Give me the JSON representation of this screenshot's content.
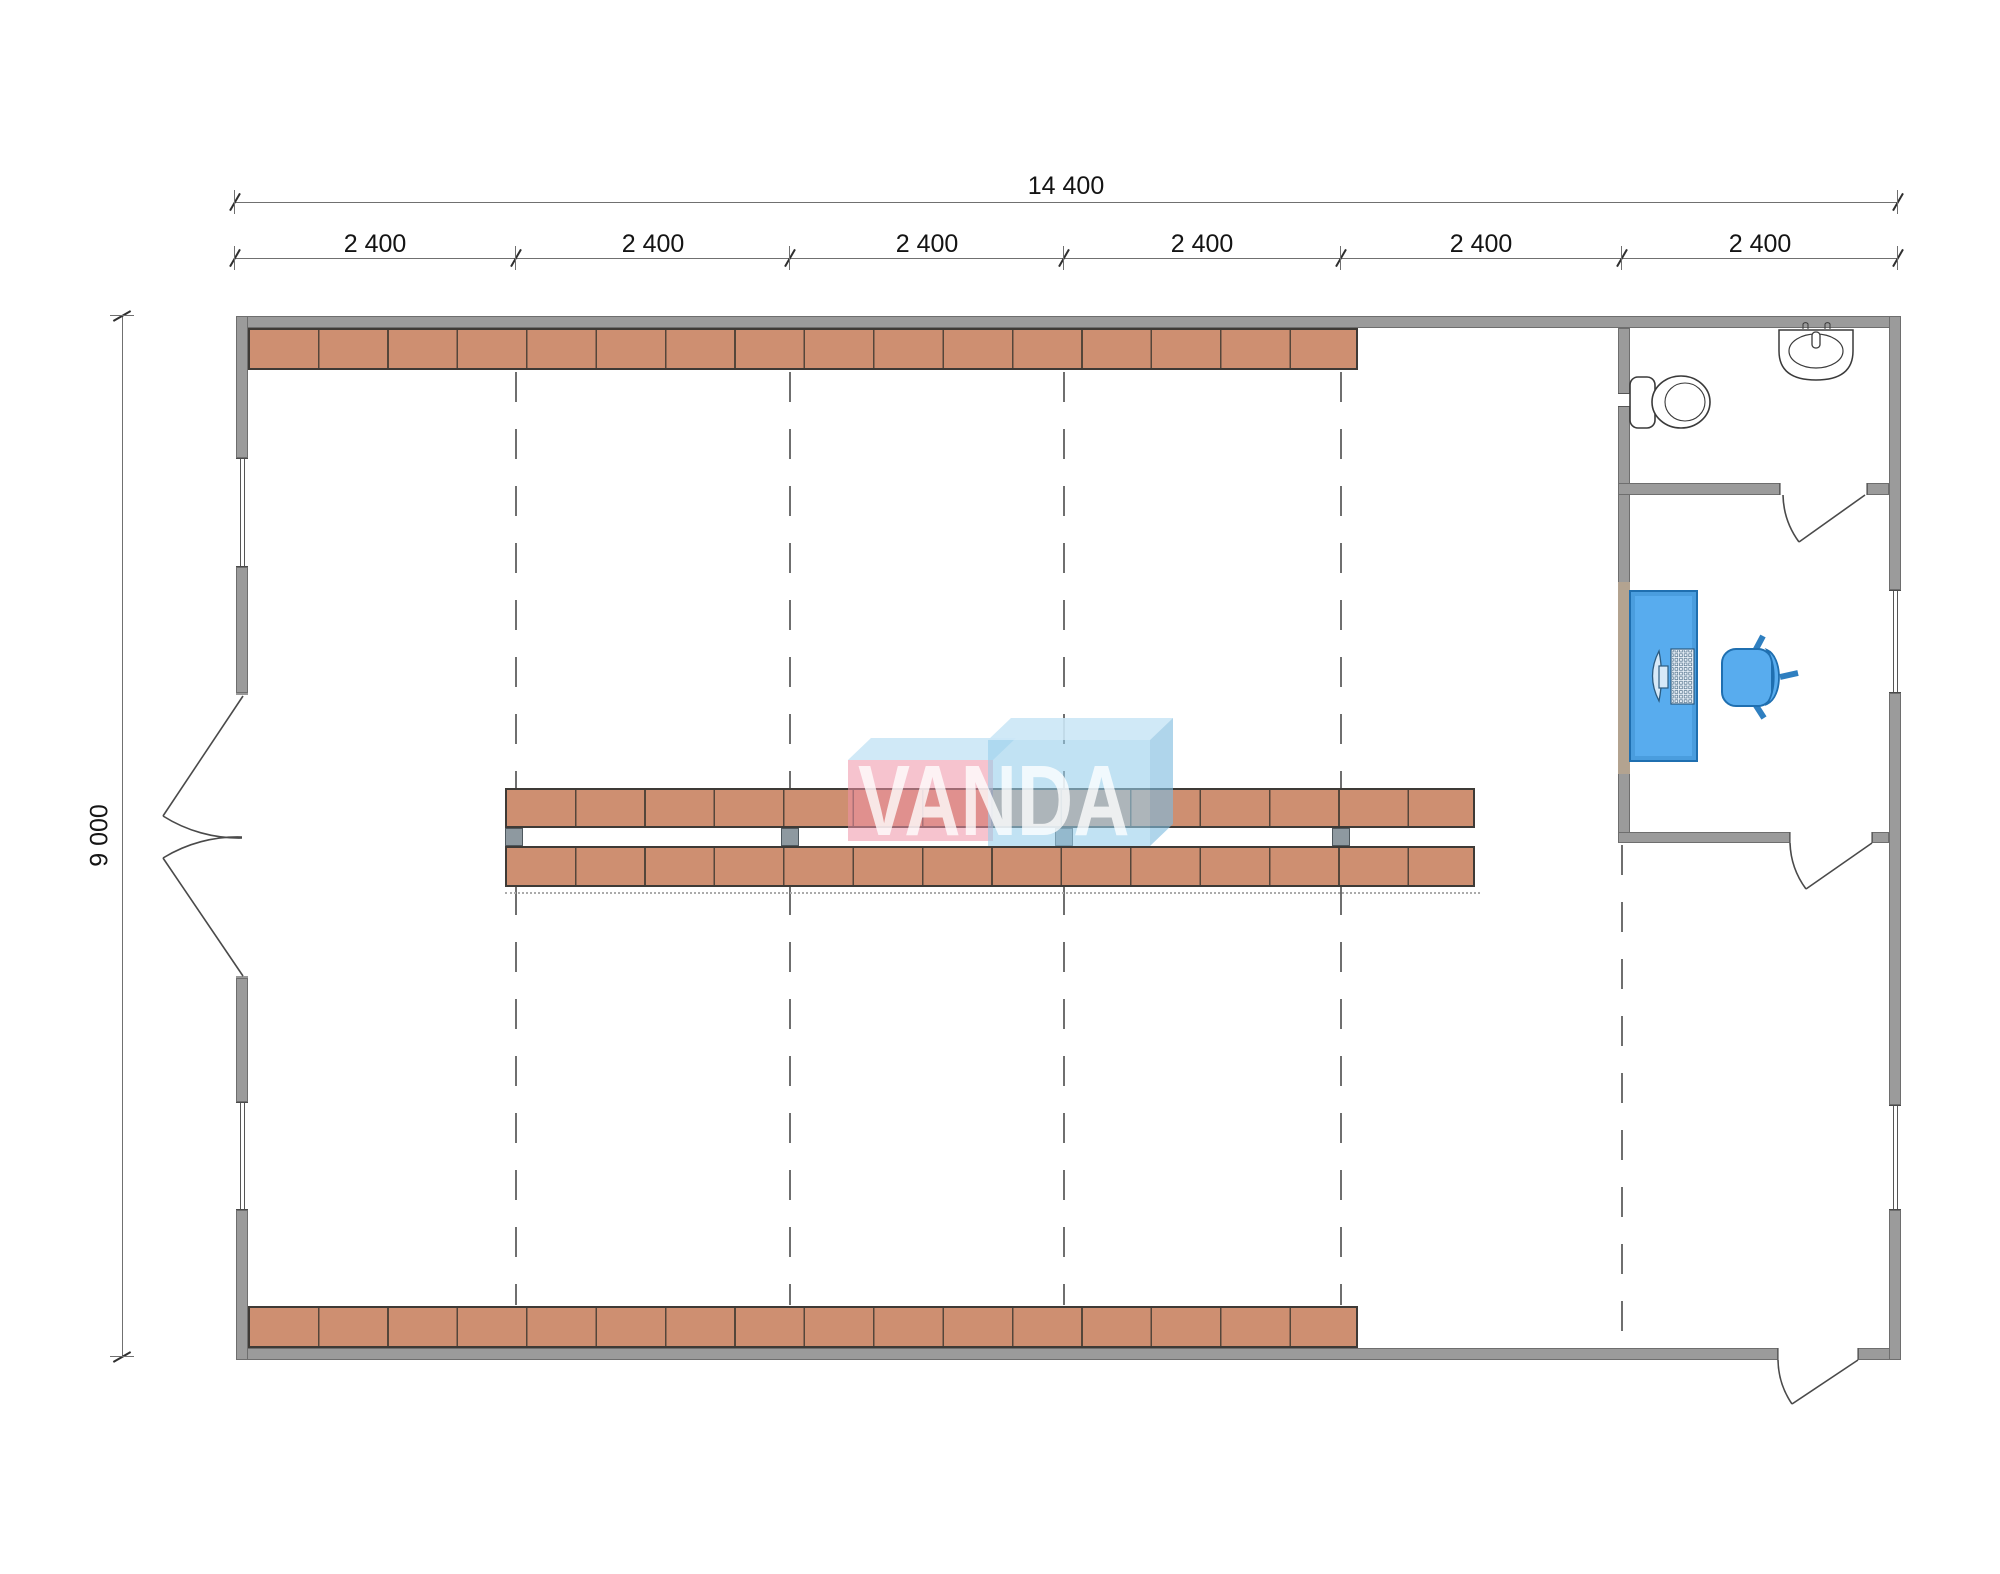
{
  "watermark": {
    "text": "VANDA"
  },
  "dimensions": {
    "total_width": "14 400",
    "total_height": "9 000",
    "bays": [
      "2 400",
      "2 400",
      "2 400",
      "2 400",
      "2 400",
      "2 400"
    ]
  },
  "palette": {
    "wall_fill": "#9b9b9b",
    "wall_outline": "#6e6e6e",
    "shelf_fill": "#ce8f71",
    "shelf_divider": "#55463a",
    "shelf_border": "#3e3a36",
    "column_post": "#8e99a0",
    "grid_dash": "#6f6f6f",
    "dimension_line": "#707070",
    "dimension_text": "#141414",
    "furniture_blue": "#58acee",
    "furniture_blue_dark": "#1f6fb0",
    "fixture_stroke": "#3a3a3a",
    "logo_pink": "rgba(238,146,165,0.55)",
    "logo_blue": "rgba(151,206,235,0.60)",
    "logo_top_face": "rgba(203,231,246,0.90)",
    "logo_text_color": "rgba(255,255,255,0.78)"
  }
}
